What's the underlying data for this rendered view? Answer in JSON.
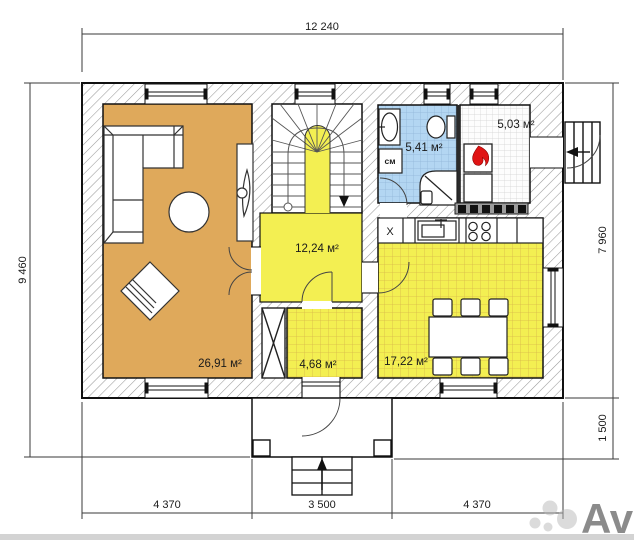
{
  "title": "House floor plan",
  "labels": {
    "dim_top": "12 240",
    "dim_left": "9 460",
    "dim_right_upper": "7 960",
    "dim_right_lower": "1 500",
    "dim_bottom_left": "4 370",
    "dim_bottom_center": "3 500",
    "dim_bottom_right": "4 370"
  },
  "rooms": {
    "living_room": {
      "area_label": "26,91 м²",
      "color": "#dfa95b"
    },
    "hallway": {
      "area_label": "12,24 м²",
      "color": "#f3ef52"
    },
    "vestibule": {
      "area_label": "4,68 м²",
      "color": "#f3ef52"
    },
    "bathroom": {
      "area_label": "5,41 м²",
      "washer_label": "см",
      "color": "#b3d6f2"
    },
    "boiler_room": {
      "area_label": "5,03 м²",
      "color": "#fdfdfd"
    },
    "kitchen": {
      "area_label": "17,22 м²",
      "fridge_label": "X",
      "color": "#f3ef52"
    }
  },
  "watermark": {
    "text": "Avito",
    "color": "#b8b8b8"
  },
  "colors": {
    "wall_hatch": "#9a9a9a",
    "flame": "#e01414",
    "counter_strip": "#9c9c9c",
    "dimension_line": "#3a3a3a"
  }
}
